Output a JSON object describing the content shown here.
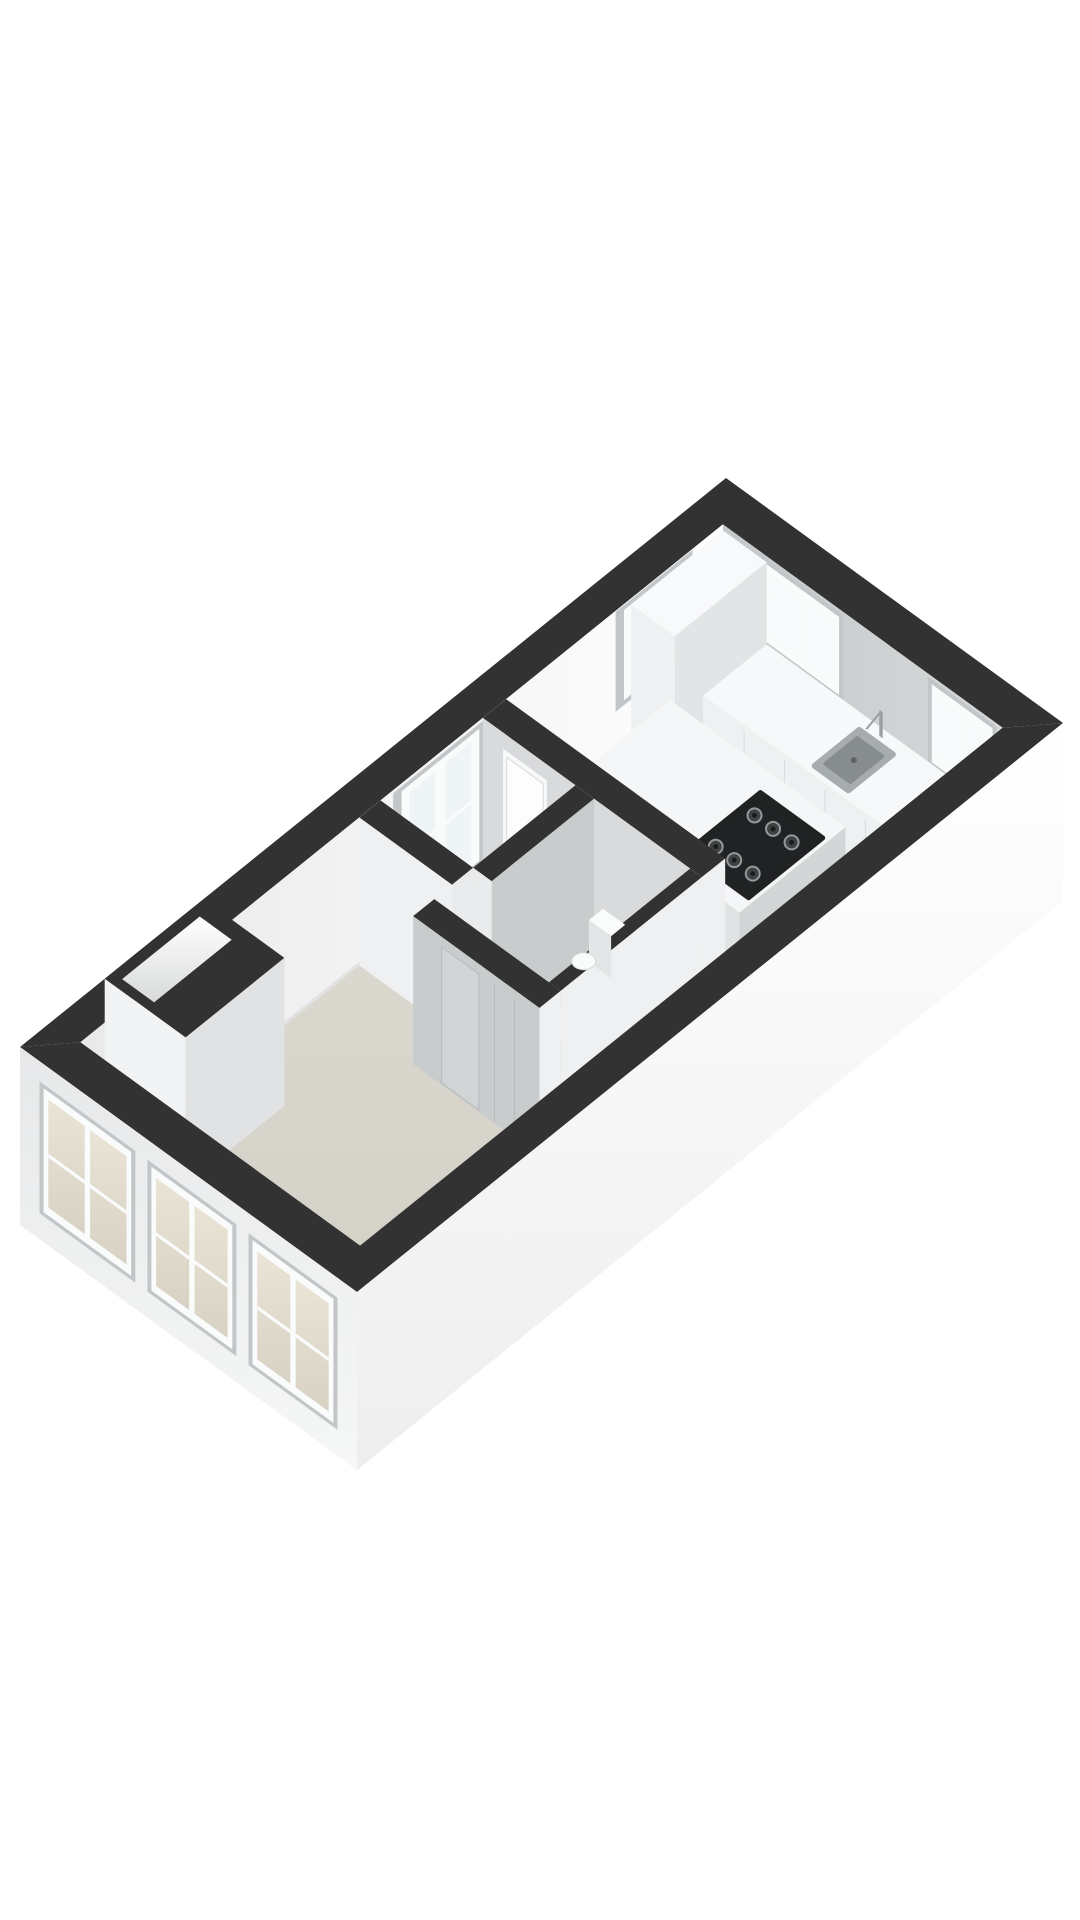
{
  "meta": {
    "type": "3d-floorplan-render",
    "background": "#ffffff"
  },
  "floorplan": {
    "rooms": [
      "kitchen",
      "hallway",
      "bathroom",
      "living-room"
    ],
    "fixtures": [
      "wall-top-band",
      "kitchen-counter",
      "kitchen-sink",
      "faucet",
      "kitchen-island",
      "cooktop",
      "tall-cabinet",
      "toilet",
      "interior-door",
      "bathroom-door",
      "entry-niche",
      "kitchen-window",
      "hallway-window",
      "ne-window-left",
      "ne-window-right",
      "facade-windows"
    ],
    "colors": {
      "background": "#ffffff",
      "wallTop": "#323232",
      "nwWallLight": "#fefefe",
      "nwWallDark": "#e9e9e9",
      "neWallDark": "#c5c8ca",
      "neWallLight": "#d6d8d9",
      "floorKitchen": "#d3ccba",
      "floorLivingLight": "#dcd9d1",
      "floorLivingDark": "#d2cfc5",
      "counterTop": "#f6f8f9",
      "counterFront": "#eef1f2",
      "counterEnd": "#dfe2e3",
      "counterSeam": "#d9dcdd",
      "cabinetTop": "#f8f9fa",
      "cabinetFront": "#eef0f1",
      "cabinetSide": "#e2e4e6",
      "islandTop": "#f5f6f7",
      "islandFront": "#e0e3e4",
      "islandSide": "#d3d6d7",
      "cooktop": "#202223",
      "burnerRing": "#96989a",
      "burnerFill": "#3f4243",
      "burnerCenter": "#191a1b",
      "sinkOuter": "#a7acaf",
      "sinkBasin": "#878c8f",
      "sinkDrain": "#5f6365",
      "steel": "#9ba0a3",
      "partitionGrey": "#c9cccd",
      "partitionMid": "#d8dadb",
      "partitionLight": "#eef0f1",
      "endFace": "#e9ebec",
      "doorOpening": "#f7f8f9",
      "doorLeaf": "#fdfdfd",
      "doorEdge": "#d6d9da",
      "bathDoor": "#d2d5d6",
      "seam": "#b6b9ba",
      "glassCool": "#eff5f7",
      "glassBright": "#f7fbfc",
      "glassWarmA": "#eae4d6",
      "glassWarmB": "#d8d2c5",
      "frameWhite": "#fafbfb",
      "reveal": "#c3c6c8",
      "extSEtop": "#ffffff",
      "extSEbottom": "#eeeeee",
      "extSWtop": "#e7e8e9",
      "extSWbottom": "#f6f7f7",
      "toiletWhite": "#fafbfb",
      "toiletShade": "#e3e6e7",
      "voidTop": "#ffffff",
      "voidBottom": "#d8dada",
      "nicheFront": "#f2f3f4",
      "nicheSide": "#e0e2e3",
      "baseShadow": "rgba(0,0,0,0.06)"
    }
  }
}
